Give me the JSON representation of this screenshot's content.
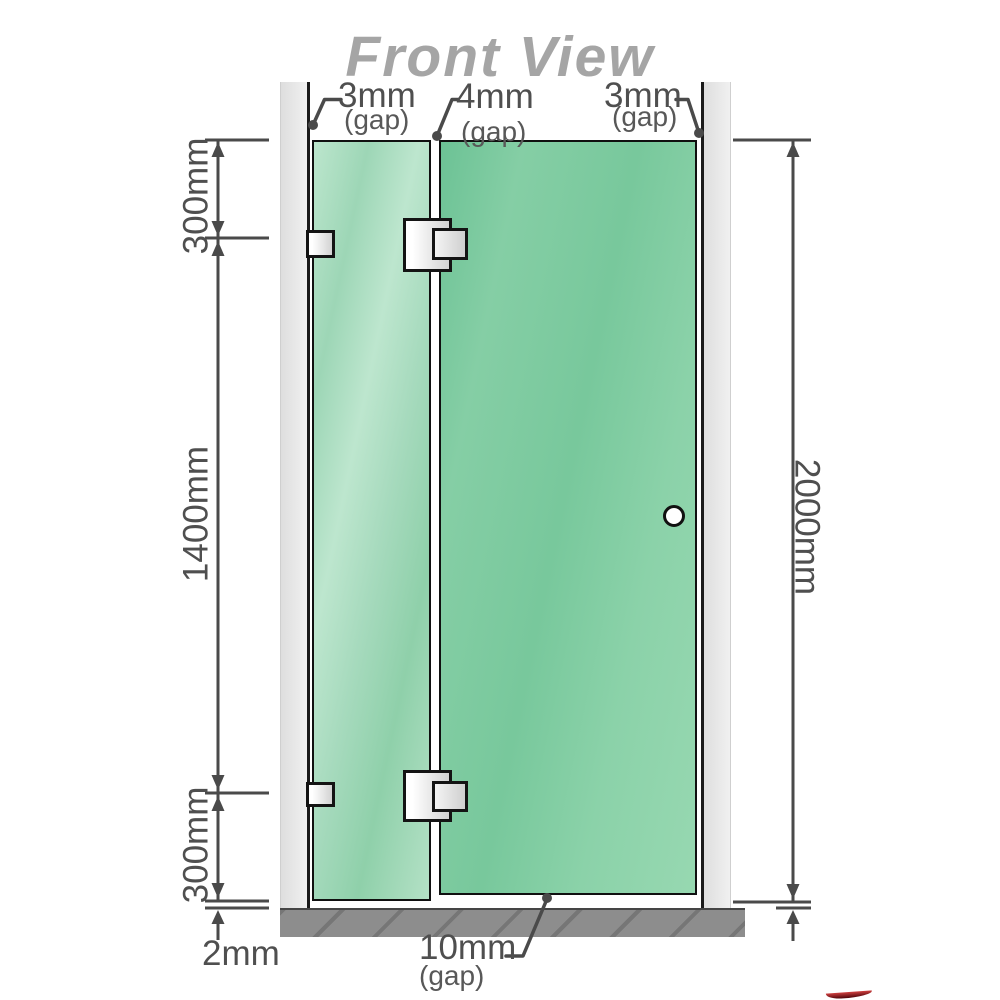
{
  "title": "Front View",
  "annotations": {
    "top_gaps": [
      {
        "value": "3mm",
        "note": "(gap)"
      },
      {
        "value": "4mm",
        "note": "(gap)"
      },
      {
        "value": "3mm",
        "note": "(gap)"
      }
    ],
    "left_heights": [
      {
        "value": "300mm"
      },
      {
        "value": "1400mm"
      },
      {
        "value": "300mm"
      }
    ],
    "right_height": {
      "value": "2000mm"
    },
    "bottom": {
      "floor_gap": {
        "value": "2mm"
      },
      "door_floor_gap": {
        "value": "10mm",
        "note": "(gap)"
      }
    }
  },
  "colors": {
    "title_gray": "#a5a5a5",
    "dimension_gray": "#4a4a4a",
    "glass_green": "#7dc9a0",
    "glass_green_light": "#aedec4",
    "wall_gray": "#e7e7e7",
    "floor_gray": "#8d8d8d",
    "hardware_outline": "#141414",
    "watermark_red": "#8f1020"
  }
}
